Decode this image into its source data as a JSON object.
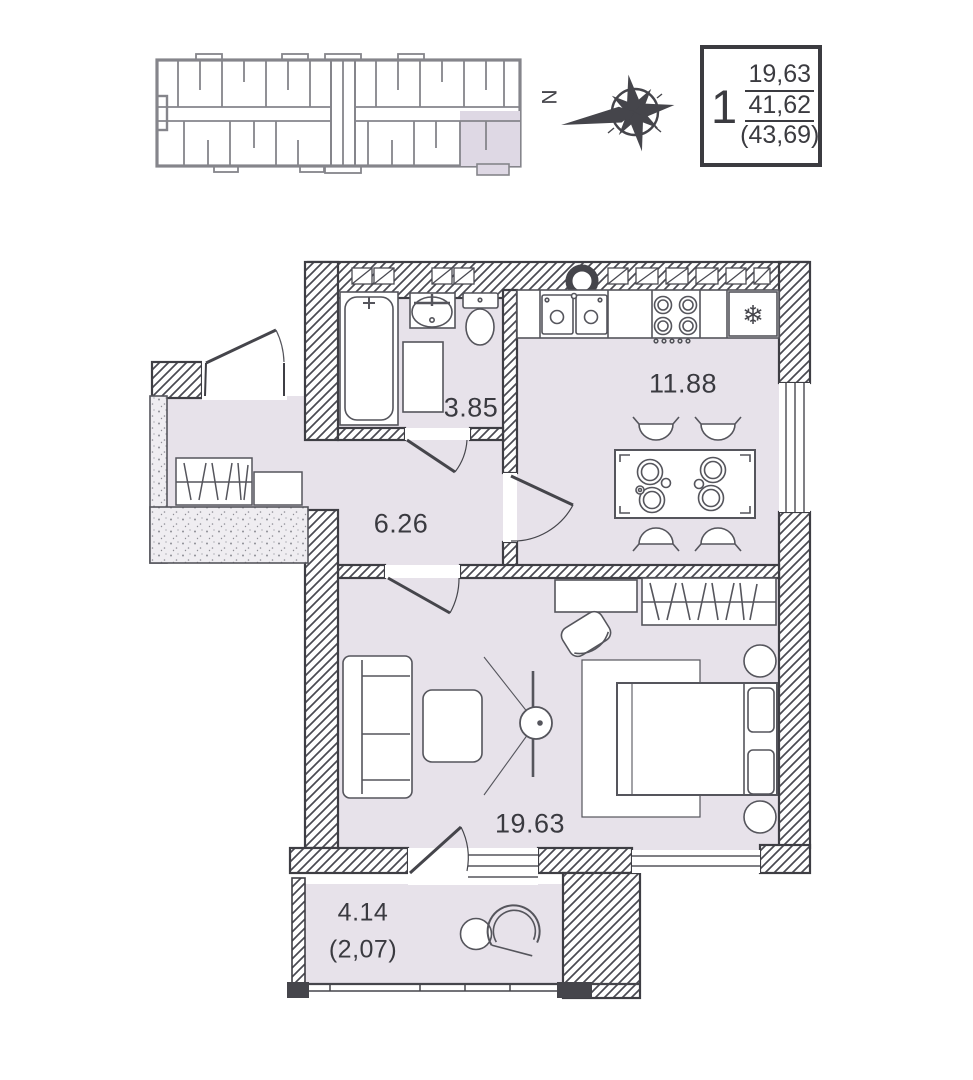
{
  "legend": {
    "unit_number": "1",
    "living_area": "19,63",
    "apartment_area": "41,62",
    "total_area": "(43,69)"
  },
  "compass": {
    "north_label": "N"
  },
  "rooms": {
    "bathroom": {
      "area": "3.85"
    },
    "kitchen": {
      "area": "11.88"
    },
    "hallway": {
      "area": "6.26"
    },
    "living_room": {
      "area": "19.63"
    },
    "balcony": {
      "area": "4.14",
      "area_coefficient": "(2,07)"
    }
  },
  "icons": {
    "fridge_snowflake": "❄"
  },
  "colors": {
    "floor": "#e7e2ea",
    "wall": "#45454b",
    "key_plan_wall": "#85858b",
    "highlight": "#ded8e4"
  }
}
